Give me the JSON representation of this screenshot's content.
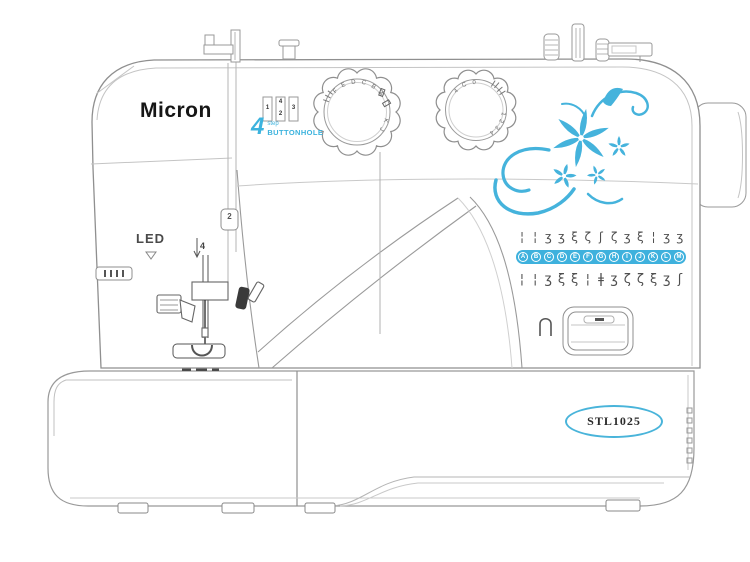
{
  "branding": {
    "logo": "Micron",
    "model": "STL1025"
  },
  "labels": {
    "led": "LED",
    "buttonhole_number": "4",
    "buttonhole_step": "step",
    "buttonhole_word": "BUTTONHOLE"
  },
  "thread_guides": {
    "guide_2": "2",
    "guide_4": "4"
  },
  "buttonhole_indicator": {
    "steps": [
      "1",
      "4",
      "2",
      "3"
    ]
  },
  "dials": {
    "pattern_selector": {
      "arc_letters": "F E D C B A",
      "side_letters": "K J"
    },
    "stitch_length": {
      "arc_numbers": "4 C 0",
      "side_numbers": "1 2 3 4"
    }
  },
  "stitch_chart": {
    "top_row_symbols": [
      "¦",
      "¦",
      "ʒ",
      "ʒ",
      "ξ",
      "ζ",
      "ʃ",
      "ζ",
      "ʒ",
      "ξ",
      "¦",
      "ʒ",
      "ʒ"
    ],
    "selector_row": [
      "A",
      "B",
      "C",
      "D",
      "E",
      "F",
      "G",
      "H",
      "I",
      "J",
      "K",
      "L",
      "M"
    ],
    "bottom_row_symbols": [
      "¦",
      "¦",
      "ʒ",
      "ξ",
      "ξ",
      "¦",
      "ǂ",
      "ʒ",
      "ζ",
      "ζ",
      "ξ",
      "ʒ",
      "ʃ"
    ]
  },
  "colors": {
    "accent_blue": "#45b3dc",
    "bar_blue": "#3eb1dd",
    "line_gray": "#9a9a9a",
    "dark_detail": "#3a3a3a"
  }
}
